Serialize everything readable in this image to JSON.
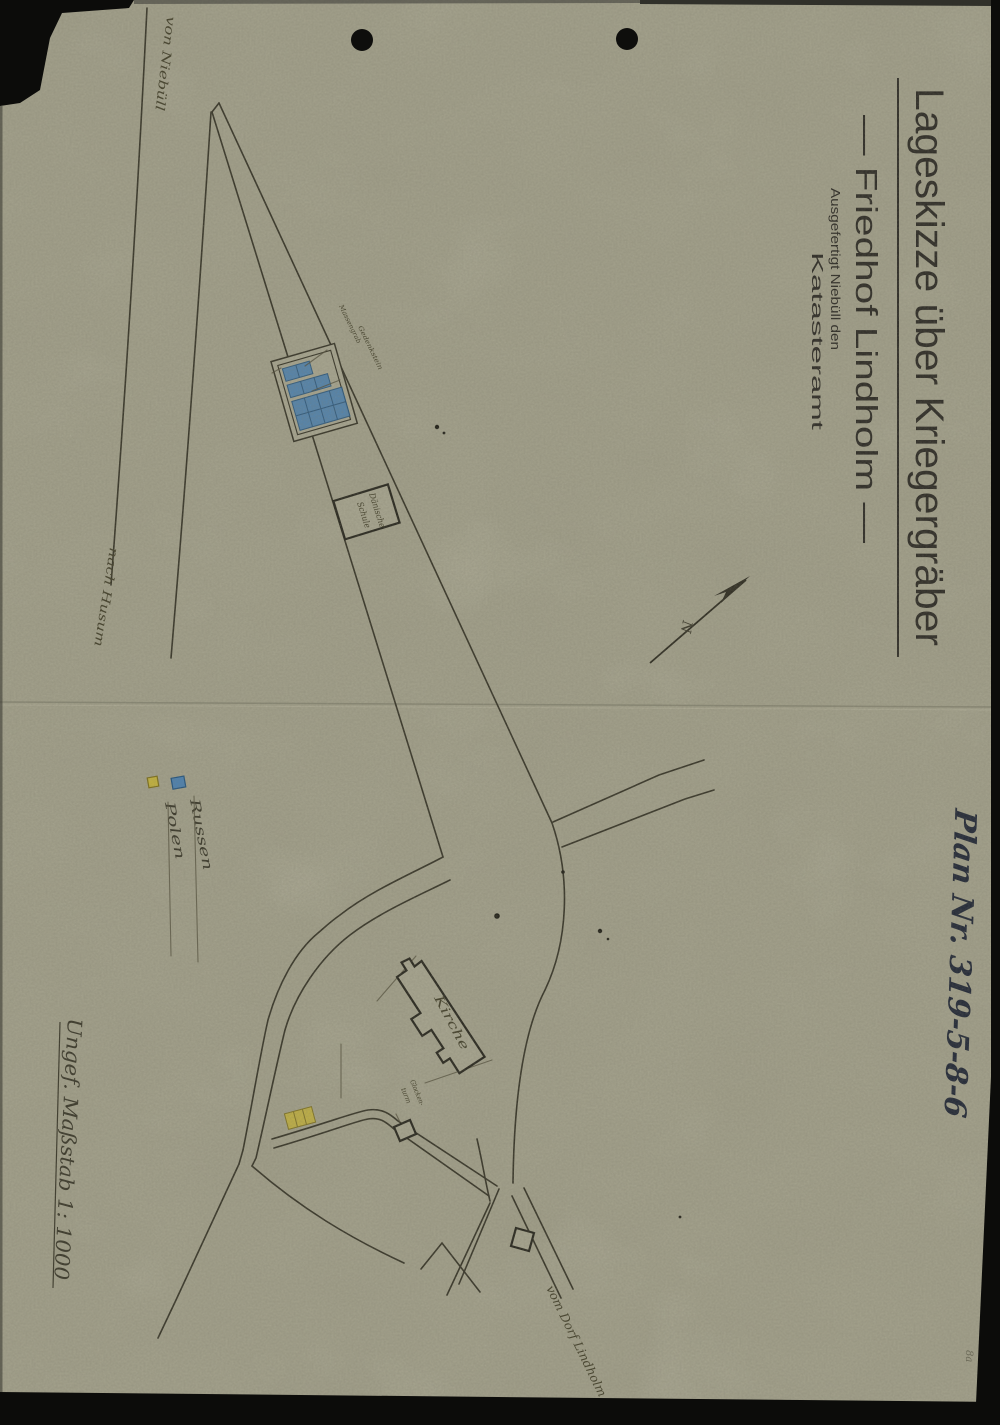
{
  "title_block": {
    "title": "Lageskizze über Kriegergräber",
    "subtitle": "— Friedhof Lindholm —",
    "issued": "Ausgefertigt  Niebüll den",
    "office": "Katasteramt"
  },
  "annotations": {
    "plan_number": "Plan Nr. 319-5-8-6",
    "scale": "Ungef. Maßstab 1: 1000",
    "corner_mark": "8a"
  },
  "legend": {
    "russians": "Russen",
    "poles": "Polen"
  },
  "map_labels": {
    "road_from_niebuell": "von Niebüll",
    "road_to_husum": "nach Husum",
    "road_from_lindholm": "vom Dorf Lindholm",
    "church": "Kirche",
    "bell_tower_line1": "Glocken-",
    "bell_tower_line2": "turm",
    "school_line1": "Dänische",
    "school_line2": "Schule",
    "grave_annotation_1": "Massengrab",
    "grave_annotation_2": "Gedenkstein",
    "north_mark": "N"
  },
  "colors": {
    "paper": "#a19f8a",
    "ink": "#3b392c",
    "russian_grave_fill": "#4f81ad",
    "polish_grave_fill": "#c0b040",
    "handwriting_ink": "#272d3a"
  }
}
